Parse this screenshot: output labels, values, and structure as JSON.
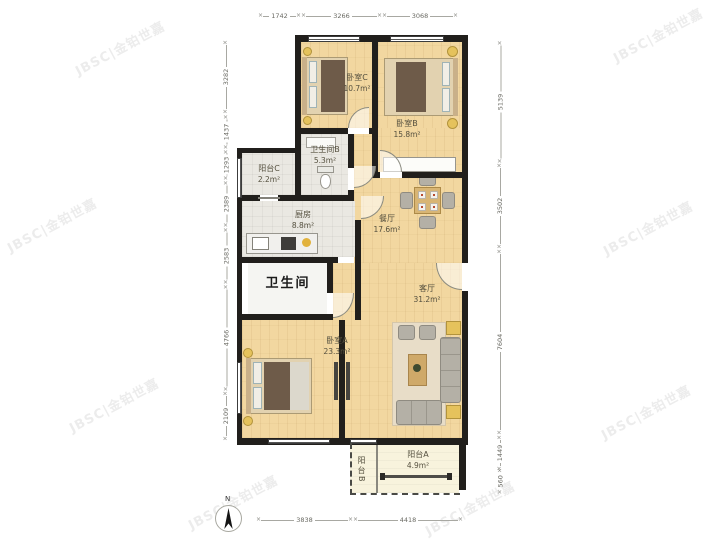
{
  "watermark": {
    "text": "JBSC|金铂世嘉"
  },
  "rooms": {
    "bedroom_c": {
      "name": "卧室C",
      "area": "10.7m²"
    },
    "bedroom_b": {
      "name": "卧室B",
      "area": "15.8m²"
    },
    "bathroom_b": {
      "name": "卫生间B",
      "area": "5.3m²"
    },
    "balcony_c": {
      "name": "阳台C",
      "area": "2.2m²"
    },
    "kitchen": {
      "name": "厨房",
      "area": "8.8m²"
    },
    "dining": {
      "name": "餐厅",
      "area": "17.6m²"
    },
    "bathroom": {
      "name": "卫生间"
    },
    "living": {
      "name": "客厅",
      "area": "31.2m²"
    },
    "bedroom_a": {
      "name": "卧室A",
      "area": "23.3m²"
    },
    "balcony_a": {
      "name": "阳台A",
      "area": "4.9m²"
    },
    "balcony_b": {
      "name": "阳台B"
    }
  },
  "dimensions": {
    "top": [
      "1742",
      "3266",
      "3068"
    ],
    "left": [
      "3282",
      "1437",
      "1293",
      "2389",
      "2583",
      "4766",
      "2109"
    ],
    "right": [
      "5139",
      "3502",
      "7604",
      "1449",
      "560"
    ],
    "bottom": [
      "3838",
      "4418"
    ]
  },
  "compass": {
    "label": "N"
  }
}
